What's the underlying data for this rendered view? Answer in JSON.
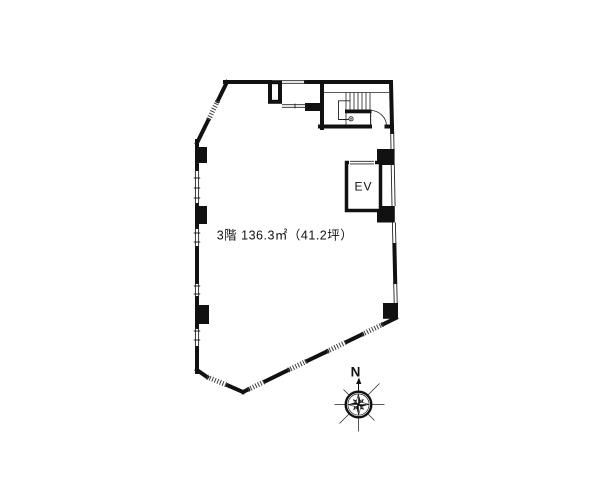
{
  "page": {
    "background": "#ffffff"
  },
  "floor_plan": {
    "area_label": "3階 136.3㎡（41.2坪）",
    "floor": "3階",
    "area_sqm": "136.3㎡",
    "area_tsubo": "41.2坪",
    "elevator_label": "EV",
    "colors": {
      "wall": "#111111",
      "detail_line": "#222222",
      "window_hatch": "#404040",
      "background": "#ffffff"
    }
  },
  "compass": {
    "north_label": "N"
  }
}
